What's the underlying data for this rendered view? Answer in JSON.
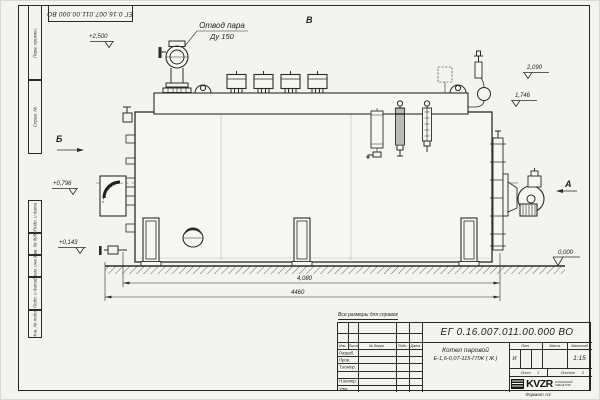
{
  "colors": {
    "paper": "#f3f3f0",
    "line": "#2b2b2b"
  },
  "frame": {
    "corner_code": "ЕГ 0.16.007.011.00.000  ВО",
    "format_label": "Формат А3",
    "margin_columns": [
      "Перв. примен.",
      "Справ. №",
      "Подп. и дата",
      "Инв. № дубл.",
      "Взам. инв. №",
      "Подп. и дата",
      "Инв. № подл."
    ]
  },
  "annotations": {
    "steam_outlet_line1": "Отвод пара",
    "steam_outlet_line2": "Ду 150",
    "view_b": "Б",
    "view_v": "В",
    "view_a": "А",
    "note": "Все размеры для справок",
    "elev_2500": "+2,500",
    "elev_2090": "2,090",
    "elev_1746": "1,746",
    "elev_0796": "+0,796",
    "elev_0143": "+0,143",
    "elev_0000": "0,000",
    "dim_4080": "4,080",
    "dim_4460": "4460"
  },
  "title_block": {
    "designation": "ЕГ 0.16.007.011.00.000  ВО",
    "product_line1": "Котел паровой",
    "product_line2": "Е-1,6-0,07-115-ГЛЖ ( Ж )",
    "col_izm": "Изм.",
    "col_list": "Лист",
    "col_doc": "№ докум.",
    "col_podp": "Подп.",
    "col_data": "Дата",
    "row_razrab": "Разраб.",
    "row_prov": "Пров.",
    "row_tkontr": "Т.контр.",
    "row_nkontr": "Н.контр.",
    "row_utv": "Утв.",
    "col_lit": "Лит.",
    "col_massa": "Масса",
    "col_scale": "Масштаб",
    "lit_value": "И",
    "scale_value": "1:15",
    "sheet_label": "Лист",
    "sheet_value": "1",
    "sheets_label": "Листов",
    "sheets_value": "2",
    "logo": "KVZR",
    "logo_sub1": "КОТЕЛЬНЫЙ",
    "logo_sub2": "ЗАВОД РЭП"
  }
}
